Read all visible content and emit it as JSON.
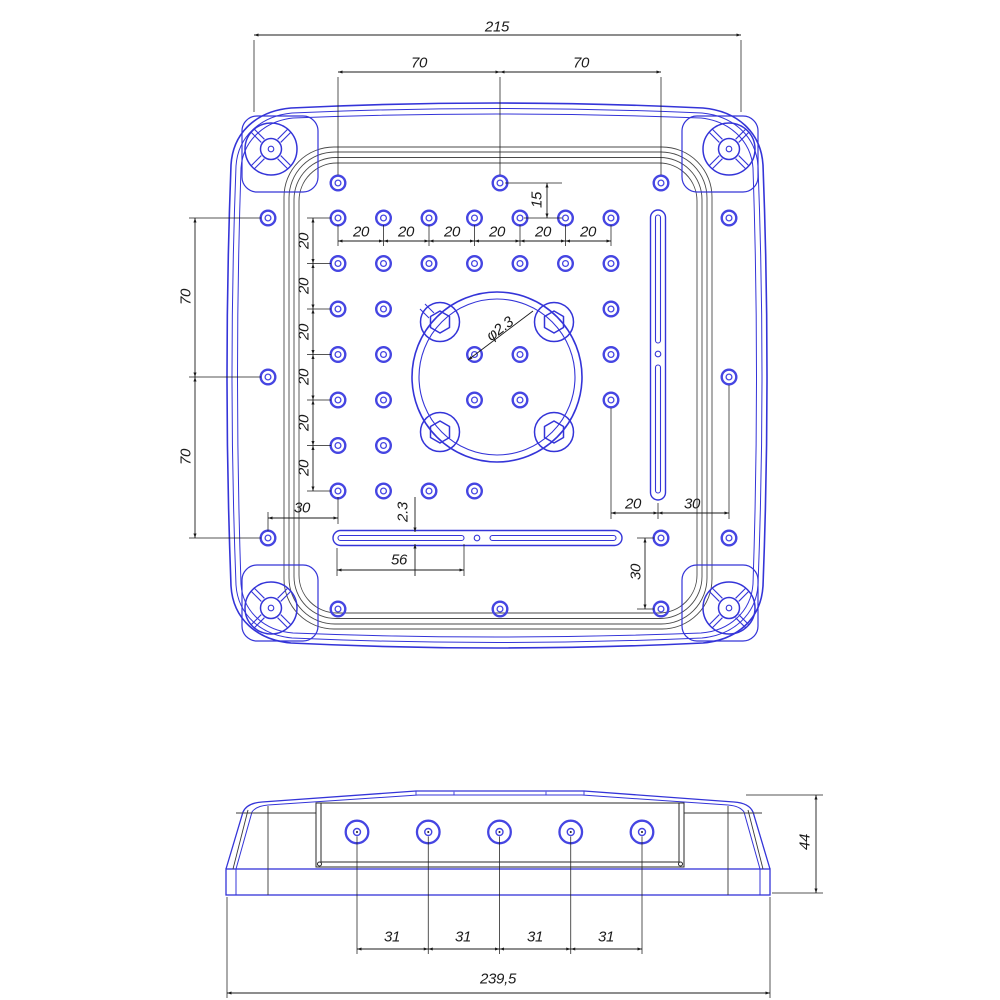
{
  "drawing": {
    "kind": "technical-cad-drawing",
    "units_note": "",
    "colors": {
      "part_outline": "#3434d8",
      "hole_accent": "#4545e2",
      "inner_plate_line": "#4a4a4a",
      "dimension_line": "#1b1b1b",
      "background": "#ffffff"
    },
    "top_view_dimensions": {
      "overall_width": "215",
      "top_hole_spans": [
        "70",
        "70"
      ],
      "top_offset": "15",
      "grid_pitch_horizontal": [
        "20",
        "20",
        "20",
        "20",
        "20",
        "20"
      ],
      "grid_pitch_vertical": [
        "20",
        "20",
        "20",
        "20",
        "20",
        "20"
      ],
      "left_hole_spans": [
        "70",
        "70"
      ],
      "center_hole_diameter": "φ2.3",
      "bottom_left_offset": "30",
      "slot_width": "2.3",
      "slot_length": "56",
      "slot_offset_right": "20",
      "right_hole_offset": "30",
      "bottom_right_vertical": "30"
    },
    "side_view_dimensions": {
      "boss_pitch": [
        "31",
        "31",
        "31",
        "31"
      ],
      "overall_width": "239,5",
      "overall_height": "44"
    }
  },
  "annotations": [
    {
      "id": "dim-overall-width",
      "label": "215"
    },
    {
      "id": "dim-top-hole-span-left",
      "label": "70"
    },
    {
      "id": "dim-top-hole-span-right",
      "label": "70"
    },
    {
      "id": "dim-top-offset",
      "label": "15"
    },
    {
      "id": "dim-grid-pitch-h-1",
      "label": "20"
    },
    {
      "id": "dim-grid-pitch-h-2",
      "label": "20"
    },
    {
      "id": "dim-grid-pitch-h-3",
      "label": "20"
    },
    {
      "id": "dim-grid-pitch-h-4",
      "label": "20"
    },
    {
      "id": "dim-grid-pitch-h-5",
      "label": "20"
    },
    {
      "id": "dim-grid-pitch-h-6",
      "label": "20"
    },
    {
      "id": "dim-grid-pitch-v-1",
      "label": "20"
    },
    {
      "id": "dim-grid-pitch-v-2",
      "label": "20"
    },
    {
      "id": "dim-grid-pitch-v-3",
      "label": "20"
    },
    {
      "id": "dim-grid-pitch-v-4",
      "label": "20"
    },
    {
      "id": "dim-grid-pitch-v-5",
      "label": "20"
    },
    {
      "id": "dim-grid-pitch-v-6",
      "label": "20"
    },
    {
      "id": "dim-left-hole-span-upper",
      "label": "70"
    },
    {
      "id": "dim-left-hole-span-lower",
      "label": "70"
    },
    {
      "id": "dim-center-hole-diameter",
      "label": "φ2.3"
    },
    {
      "id": "dim-bottom-left-offset",
      "label": "30"
    },
    {
      "id": "dim-slot-width",
      "label": "2.3"
    },
    {
      "id": "dim-slot-length",
      "label": "56"
    },
    {
      "id": "dim-slot-offset-right",
      "label": "20"
    },
    {
      "id": "dim-right-hole-offset",
      "label": "30"
    },
    {
      "id": "dim-bottom-right-vertical",
      "label": "30"
    },
    {
      "id": "dim-boss-pitch-1",
      "label": "31"
    },
    {
      "id": "dim-boss-pitch-2",
      "label": "31"
    },
    {
      "id": "dim-boss-pitch-3",
      "label": "31"
    },
    {
      "id": "dim-boss-pitch-4",
      "label": "31"
    },
    {
      "id": "dim-side-overall-width",
      "label": "239,5"
    },
    {
      "id": "dim-side-overall-height",
      "label": "44"
    }
  ]
}
